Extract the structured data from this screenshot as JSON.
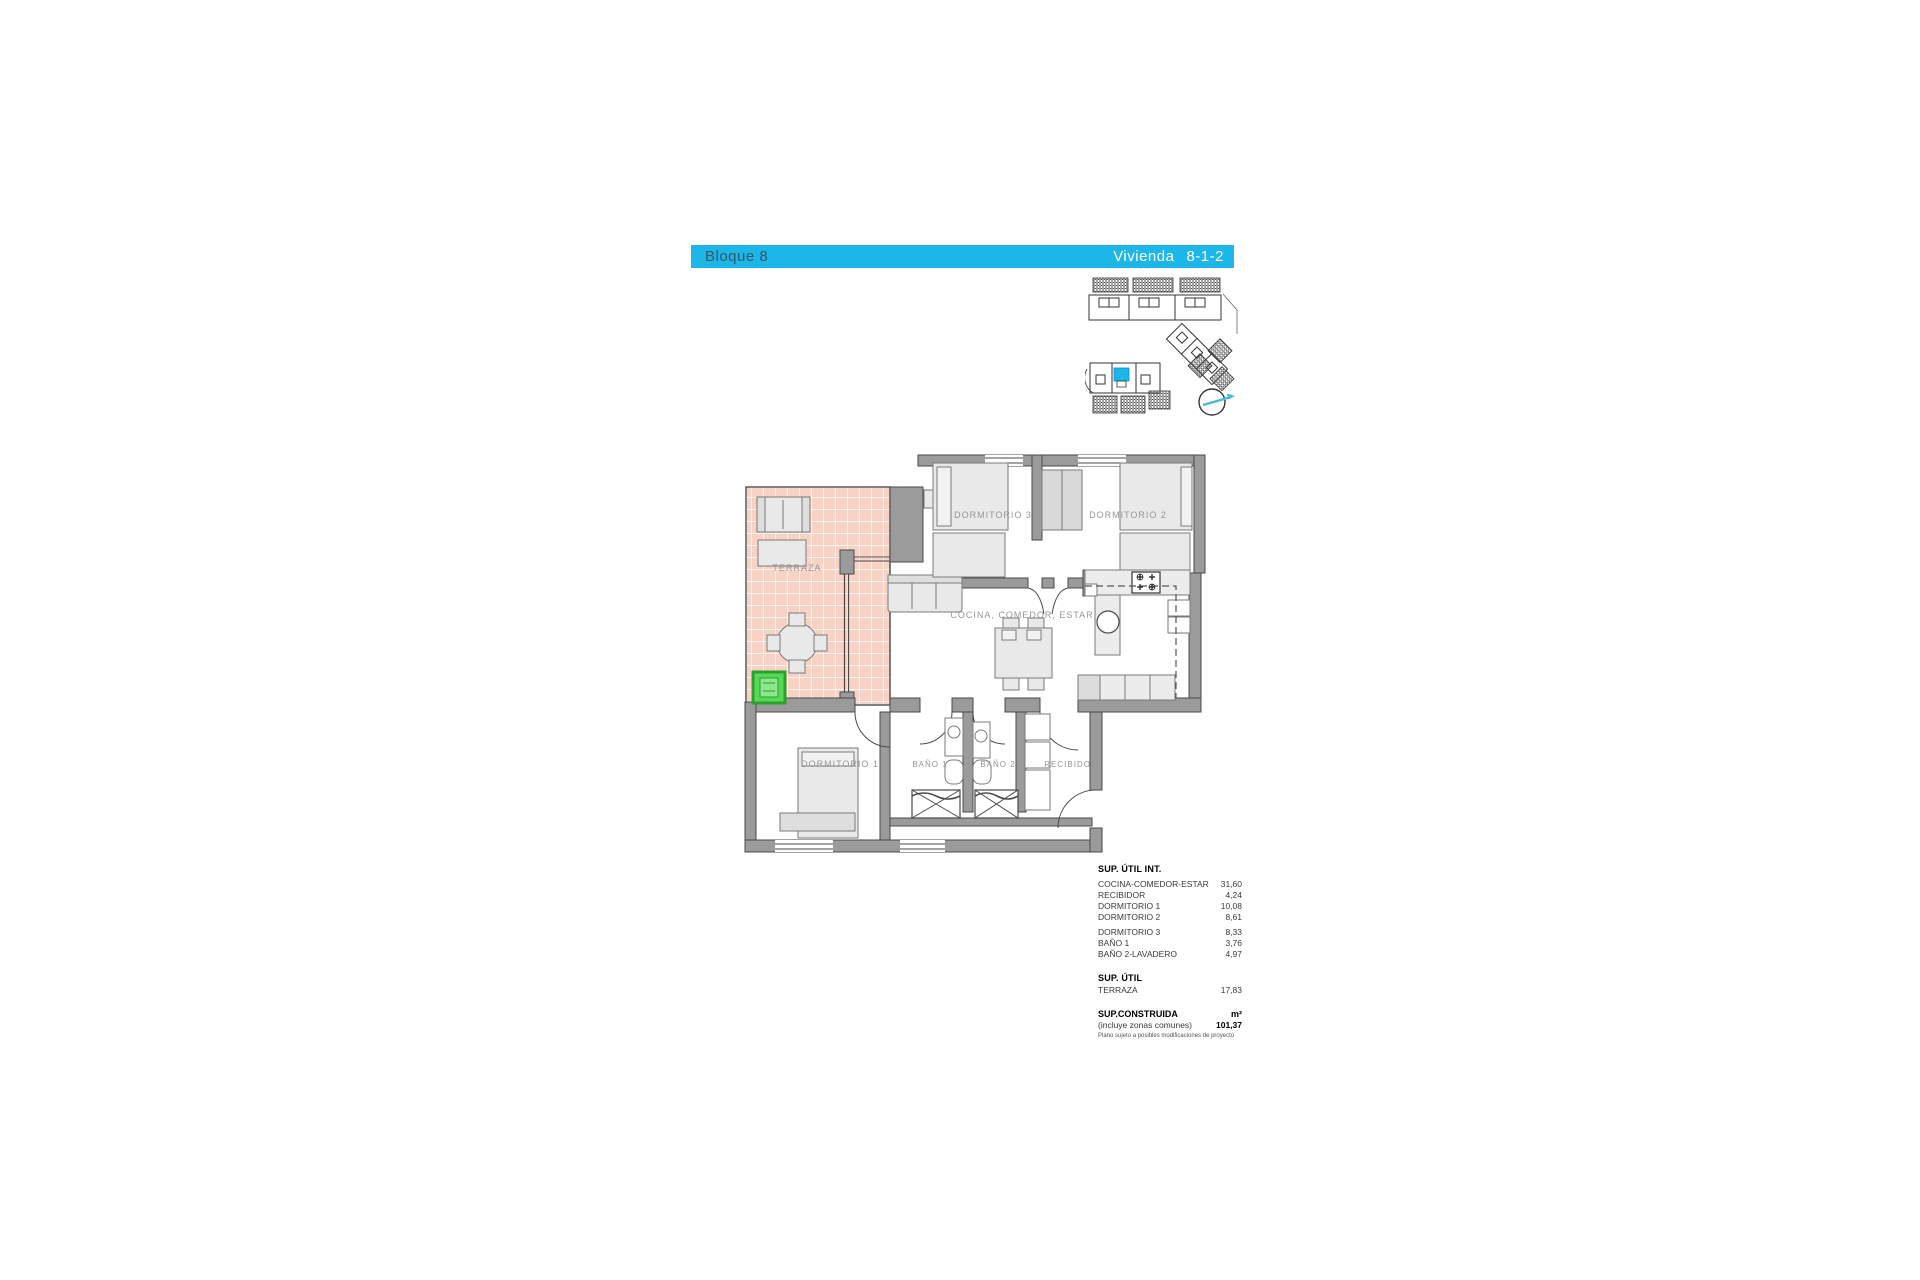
{
  "header": {
    "block_label": "Bloque 8",
    "dwelling_label": "Vivienda",
    "dwelling_number": "8-1-2"
  },
  "colors": {
    "accent_cyan": "#1cb6e9",
    "terrace_pink": "#f8d2c5",
    "highlight_green": "#57d957",
    "wall_gray": "#9b9b9b"
  },
  "floor_plan": {
    "rooms": {
      "terraza": "TERRAZA",
      "dormitorio3": "DORMITORIO 3",
      "dormitorio2": "DORMITORIO 2",
      "cocina_comedor_estar": "COCINA, COMEDOR, ESTAR",
      "dormitorio1": "DORMITORIO 1",
      "bano1": "BAÑO 1",
      "bano2": "BAÑO 2",
      "recibidor": "RECIBIDOR"
    }
  },
  "areas_table": {
    "title": "SUP. ÚTIL INT.",
    "rows": [
      {
        "label": "COCINA-COMEDOR-ESTAR",
        "value": "31,60"
      },
      {
        "label": "RECIBIDOR",
        "value": "4,24"
      },
      {
        "label": "DORMITORIO 1",
        "value": "10,08"
      },
      {
        "label": "DORMITORIO 2",
        "value": "8,61"
      },
      {
        "label": "DORMITORIO 3",
        "value": "8,33"
      },
      {
        "label": "BAÑO 1",
        "value": "3,76"
      },
      {
        "label": "BAÑO 2-LAVADERO",
        "value": "4,97"
      }
    ],
    "section2_title": "SUP. ÚTIL",
    "section2_rows": [
      {
        "label": "TERRAZA",
        "value": "17,83"
      }
    ],
    "built_title": "SUP.CONSTRUIDA",
    "built_unit": "m²",
    "built_note": "(incluye zonas comunes)",
    "built_value": "101,37",
    "disclaimer": "Plano sujeto a posibles modificaciones de proyecto"
  }
}
